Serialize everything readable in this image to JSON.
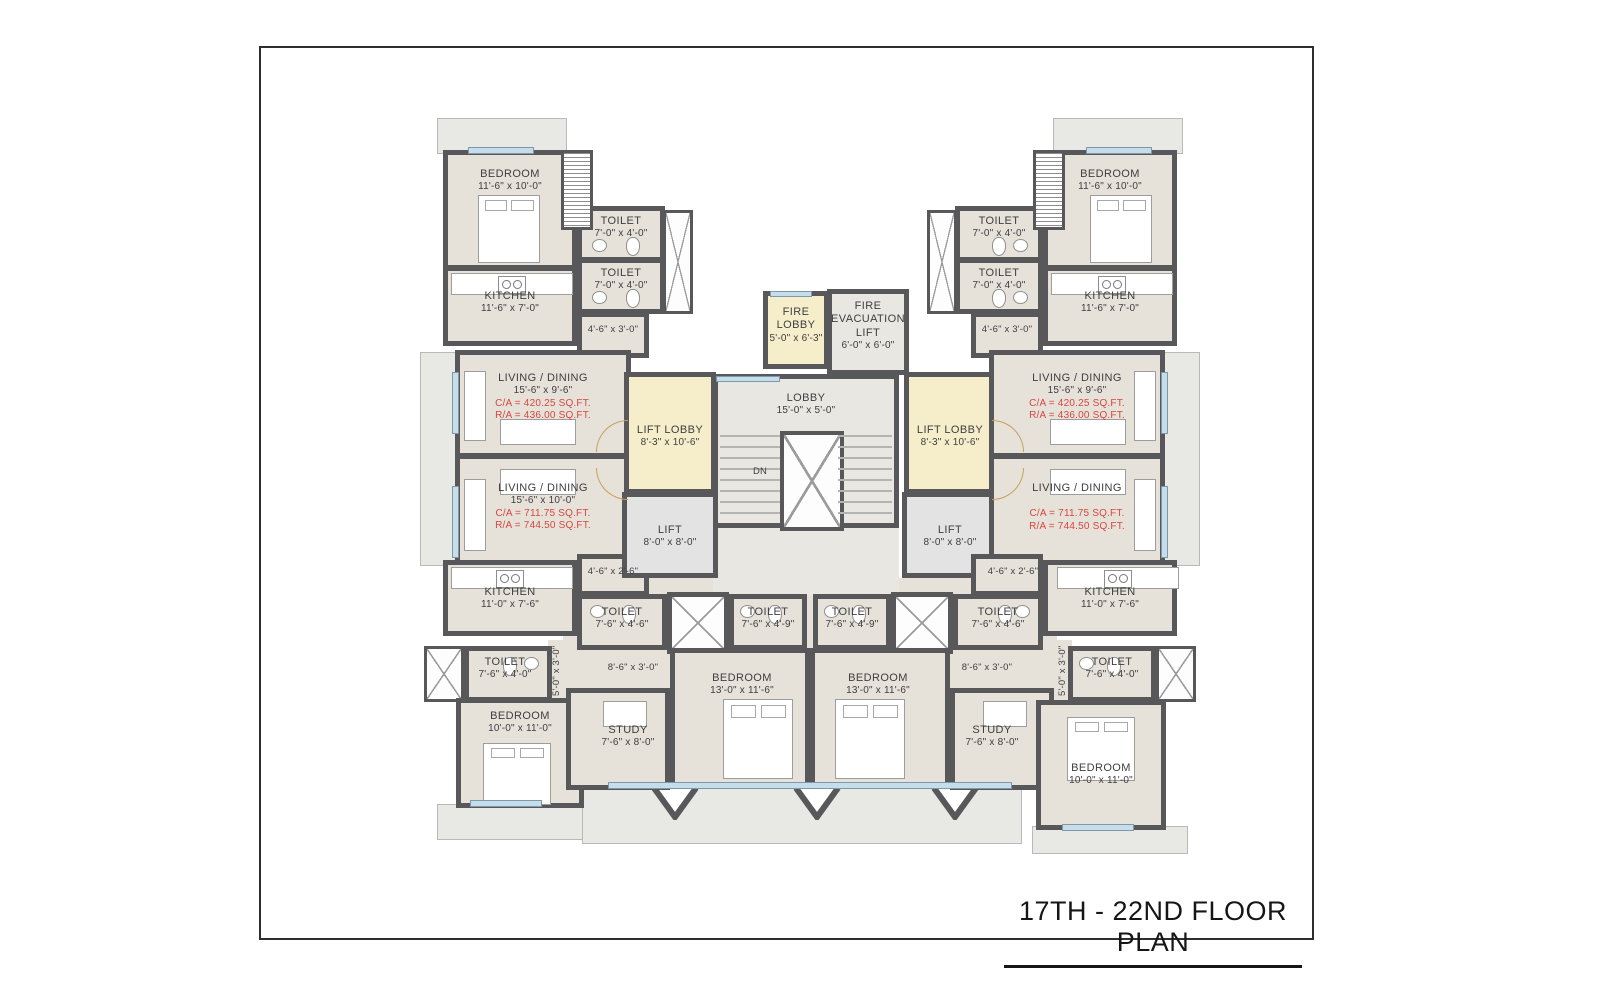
{
  "sheet": {
    "title": "17TH - 22ND FLOOR PLAN"
  },
  "colors": {
    "wall": "#58585b",
    "floor": "#e6e2da",
    "lobby_yellow": "#f6eecb",
    "window": "#c6ddeb",
    "balcony": "#e8e8e5",
    "area_text_red": "#d6473f"
  },
  "rooms": {
    "tlBedroom": {
      "name": "BEDROOM",
      "dim": "11'-6\" x 10'-0\""
    },
    "tlToilet1": {
      "name": "TOILET",
      "dim": "7'-0\" x 4'-0\""
    },
    "tlToilet2": {
      "name": "TOILET",
      "dim": "7'-0\" x 4'-0\""
    },
    "tlKitchen": {
      "name": "KITCHEN",
      "dim": "11'-6\" x 7'-0\""
    },
    "tlPassage": {
      "dim": "4'-6\" x 3'-0\""
    },
    "lLiving1": {
      "name": "LIVING / DINING",
      "dim": "15'-6\" x 9'-6\"",
      "ca": "C/A =  420.25 SQ.FT.",
      "ra": "R/A =  436.00 SQ.FT."
    },
    "lLiving2": {
      "name": "LIVING / DINING",
      "dim": "15'-6\" x 10'-0\"",
      "ca": "C/A =  711.75 SQ.FT.",
      "ra": "R/A =  744.50 SQ.FT."
    },
    "lPassage2": {
      "dim": "4'-6\" x 2'-6\""
    },
    "blKitchen": {
      "name": "KITCHEN",
      "dim": "11'-0\" x 7'-6\""
    },
    "blToilet": {
      "name": "TOILET",
      "dim": "7'-6\" x 4'-0\""
    },
    "blBedroom": {
      "name": "BEDROOM",
      "dim": "10'-0\" x 11'-0\""
    },
    "lStudy": {
      "name": "STUDY",
      "dim": "7'-6\" x 8'-0\""
    },
    "lCorridor": {
      "dim": "8'-6\" x 3'-0\""
    },
    "lVert": {
      "dim": "5'-0\" x 3'-0\""
    },
    "clToilet1": {
      "name": "TOILET",
      "dim": "7'-6\" x 4'-6\""
    },
    "clToilet2": {
      "name": "TOILET",
      "dim": "7'-6\" x 4'-9\""
    },
    "clBedroom": {
      "name": "BEDROOM",
      "dim": "13'-0\" x 11'-6\""
    },
    "lLiftLobby": {
      "name": "LIFT LOBBY",
      "dim": "8'-3\" x 10'-6\""
    },
    "lLift": {
      "name": "LIFT",
      "dim": "8'-0\" x 8'-0\""
    },
    "fireLobby": {
      "name": "FIRE LOBBY",
      "dim": "5'-0\" x 6'-3\""
    },
    "fireEvacLift": {
      "name": "FIRE EVACUATION LIFT",
      "dim": "6'-0\" x 6'-0\""
    },
    "lobby": {
      "name": "LOBBY",
      "dim": "15'-0\" x 5'-0\""
    },
    "dn": {
      "name": "DN"
    },
    "crToilet1": {
      "name": "TOILET",
      "dim": "7'-6\" x 4'-9\""
    },
    "crToilet2": {
      "name": "TOILET",
      "dim": "7'-6\" x 4'-6\""
    },
    "crBedroom": {
      "name": "BEDROOM",
      "dim": "13'-0\" x 11'-6\""
    },
    "rStudy": {
      "name": "STUDY",
      "dim": "7'-6\" x 8'-0\""
    },
    "rCorridor": {
      "dim": "8'-6\" x 3'-0\""
    },
    "rVert": {
      "dim": "5'-0\" x 3'-0\""
    },
    "rLiftLobby": {
      "name": "LIFT LOBBY",
      "dim": "8'-3\" x 10'-6\""
    },
    "rLift": {
      "name": "LIFT",
      "dim": "8'-0\" x 8'-0\""
    },
    "trBedroom": {
      "name": "BEDROOM",
      "dim": "11'-6\" x 10'-0\""
    },
    "trToilet1": {
      "name": "TOILET",
      "dim": "7'-0\" x 4'-0\""
    },
    "trToilet2": {
      "name": "TOILET",
      "dim": "7'-0\" x 4'-0\""
    },
    "trKitchen": {
      "name": "KITCHEN",
      "dim": "11'-6\" x 7'-0\""
    },
    "trPassage": {
      "dim": "4'-6\" x 3'-0\""
    },
    "rLiving1": {
      "name": "LIVING / DINING",
      "dim": "15'-6\" x 9'-6\"",
      "ca": "C/A =  420.25 SQ.FT.",
      "ra": "R/A =  436.00 SQ.FT."
    },
    "rLiving2": {
      "name": "LIVING / DINING",
      "ca": "C/A =  711.75 SQ.FT.",
      "ra": "R/A =  744.50 SQ.FT."
    },
    "rPassage2": {
      "dim": "4'-6\" x 2'-6\""
    },
    "brKitchen": {
      "name": "KITCHEN",
      "dim": "11'-0\" x 7'-6\""
    },
    "brToilet": {
      "name": "TOILET",
      "dim": "7'-6\" x 4'-0\""
    },
    "brBedroom": {
      "name": "BEDROOM",
      "dim": "10'-0\" x 11'-0\""
    }
  }
}
